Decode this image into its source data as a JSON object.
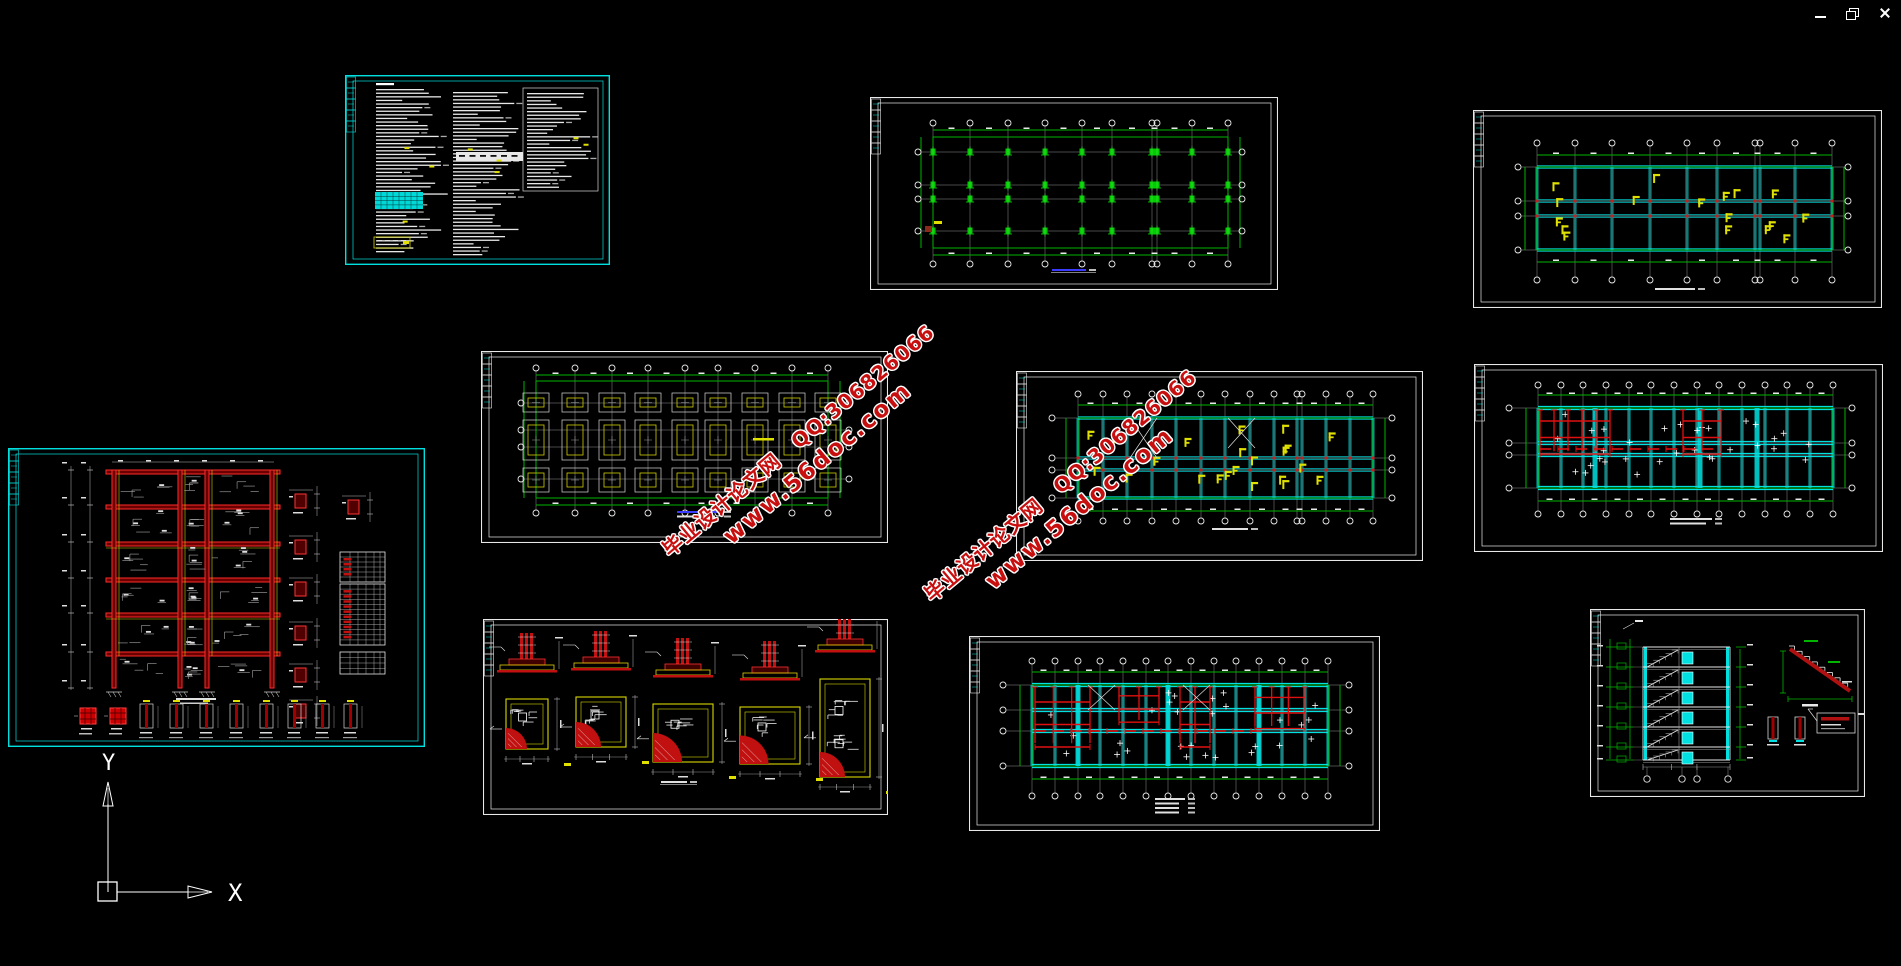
{
  "window": {
    "background": "#000000",
    "controls": [
      {
        "name": "minimize"
      },
      {
        "name": "restore"
      },
      {
        "name": "close"
      }
    ]
  },
  "ucs": {
    "x_label": "X",
    "y_label": "Y"
  },
  "watermarks": [
    {
      "x": 808,
      "y": 452,
      "rotation": -40,
      "color": "#c80f0f",
      "line1": "毕业设计论文网　QQ:306826066",
      "line2": "www.56doc.com"
    },
    {
      "x": 1070,
      "y": 497,
      "rotation": -40,
      "color": "#c80f0f",
      "line1": "毕业设计论文网　QQ:306826066",
      "line2": "www.56doc.com"
    }
  ],
  "palette": {
    "green": "#00b400",
    "bright_green": "#00d800",
    "cyan": "#00e0e0",
    "red": "#e01010",
    "dark_red": "#6a0000",
    "yellow": "#e0e000",
    "gray": "#9a9a9a",
    "white": "#e8e8e8",
    "blue_title": "#3b3bff"
  },
  "drawings": [
    {
      "id": "notes-sheet",
      "type": "notes",
      "x": 345,
      "y": 75,
      "w": 265,
      "h": 190,
      "border": "cyan",
      "seed": 11
    },
    {
      "id": "column-layout-plan",
      "type": "columns",
      "x": 870,
      "y": 97,
      "w": 408,
      "h": 193,
      "border": "white",
      "seed": 21,
      "grid": {
        "ax": [
          63,
          100,
          138,
          175,
          212,
          242,
          282,
          287,
          322,
          358
        ],
        "rows": [
          55,
          88,
          102,
          134
        ],
        "gy0": 40,
        "gy1": 151,
        "bandT": 33,
        "bandB": 158,
        "bubT": 26,
        "bubB": 167,
        "bubL": 48,
        "bubR": 372
      },
      "title": {
        "x": 182,
        "y": 172,
        "w": 34,
        "c": "#3b3bff",
        "u": 1
      }
    },
    {
      "id": "roof-beam-plan",
      "type": "beams",
      "x": 1473,
      "y": 110,
      "w": 409,
      "h": 198,
      "border": "white",
      "seed": 31,
      "grid": {
        "ax": [
          64,
          102,
          139,
          177,
          214,
          244,
          282,
          287,
          322,
          359
        ],
        "rows": [
          57,
          91,
          106,
          140
        ],
        "gy0": 57,
        "gy1": 140,
        "bandT": 45,
        "bandB": 152,
        "bubT": 33,
        "bubB": 170,
        "bubL": 45,
        "bubR": 375
      },
      "yellow": 17,
      "title": {
        "x": 182,
        "y": 178,
        "w": 40
      }
    },
    {
      "id": "frame-reinforcement-elevation",
      "type": "frame",
      "x": 8,
      "y": 448,
      "w": 417,
      "h": 299,
      "border": "cyan",
      "seed": 41,
      "cols": [
        104,
        170,
        197,
        262
      ],
      "beams": [
        22,
        57,
        94,
        130,
        165,
        204
      ],
      "rdet": [
        [
          287,
          46
        ],
        [
          287,
          92
        ],
        [
          287,
          134
        ],
        [
          287,
          178
        ],
        [
          287,
          220
        ],
        [
          287,
          256
        ],
        [
          340,
          52
        ]
      ],
      "tables": [
        [
          332,
          104,
          45,
          30,
          6
        ],
        [
          332,
          136,
          45,
          61,
          12
        ],
        [
          332,
          204,
          45,
          22,
          4
        ]
      ],
      "bxs": [
        132,
        162,
        192,
        222,
        252,
        280,
        308,
        336
      ]
    },
    {
      "id": "foundation-plan",
      "type": "foundation",
      "x": 481,
      "y": 351,
      "w": 407,
      "h": 192,
      "border": "white",
      "seed": 51,
      "grid": {
        "ax": [
          55,
          94,
          131,
          167,
          204,
          237,
          274,
          311,
          347
        ],
        "rows": [
          52,
          79,
          96,
          128
        ],
        "gy0": 30,
        "gy1": 147,
        "bandT": 24,
        "bandB": 154,
        "bubT": 17,
        "bubB": 162,
        "bubL": 40,
        "bubR": 368
      },
      "frows": [
        {
          "y": 42,
          "h": 19
        },
        {
          "y": 69,
          "h": 40
        },
        {
          "y": 117,
          "h": 24
        }
      ],
      "title": {
        "x": 196,
        "y": 160,
        "w": 44,
        "lines": 2,
        "c": "#3b3bff"
      }
    },
    {
      "id": "floor-beam-plan",
      "type": "beams",
      "x": 1016,
      "y": 371,
      "w": 407,
      "h": 190,
      "border": "white",
      "seed": 61,
      "grid": {
        "ax": [
          62,
          87,
          111,
          136,
          160,
          185,
          209,
          234,
          258,
          281,
          286,
          310,
          334,
          357
        ],
        "rows": [
          47,
          87,
          99,
          127
        ],
        "gy0": 47,
        "gy1": 127,
        "bandT": 34,
        "bandB": 140,
        "bubT": 23,
        "bubB": 150,
        "bubL": 36,
        "bubR": 376
      },
      "yellow": 22,
      "xmarks": [
        [
          114,
          47,
          27,
          40
        ],
        [
          212,
          47,
          27,
          30
        ]
      ],
      "title": {
        "x": 196,
        "y": 157,
        "w": 36
      }
    },
    {
      "id": "slab-reinforcement-plan-1",
      "type": "slab",
      "x": 1474,
      "y": 364,
      "w": 409,
      "h": 188,
      "border": "white",
      "seed": 71,
      "grid": {
        "ax": [
          64,
          87,
          109,
          132,
          155,
          177,
          200,
          223,
          245,
          268,
          291,
          313,
          336,
          359
        ],
        "rows": [
          44,
          79,
          91,
          124
        ],
        "gy0": 44,
        "gy1": 124,
        "bandT": 31,
        "bandB": 137,
        "bubT": 21,
        "bubB": 150,
        "bubL": 35,
        "bubR": 378
      },
      "thick": [
        121,
        226,
        283
      ],
      "red": [
        [
          66,
          46,
          70,
          55
        ],
        [
          209,
          46,
          38,
          55
        ]
      ],
      "redRow": [
        66,
        246,
        85
      ],
      "plus": 32,
      "title": {
        "x": 196,
        "y": 154,
        "w": 42,
        "lines": 2
      }
    },
    {
      "id": "footing-details",
      "type": "fdetails",
      "x": 483,
      "y": 619,
      "w": 405,
      "h": 196,
      "border": "white",
      "seed": 81,
      "items": [
        {
          "cx": 44,
          "pw": 42,
          "ph": 50,
          "py": 80
        },
        {
          "cx": 118,
          "pw": 50,
          "ph": 50,
          "py": 78
        },
        {
          "cx": 200,
          "pw": 60,
          "ph": 58,
          "py": 85
        },
        {
          "cx": 287,
          "pw": 60,
          "ph": 57,
          "py": 88
        },
        {
          "cx": 362,
          "pw": 50,
          "ph": 98,
          "py": 60
        }
      ],
      "title": {
        "x": 178,
        "y": 162,
        "w": 26,
        "u": 1
      }
    },
    {
      "id": "slab-reinforcement-plan-2",
      "type": "slab",
      "x": 969,
      "y": 636,
      "w": 411,
      "h": 195,
      "border": "white",
      "seed": 91,
      "grid": {
        "ax": [
          63,
          86,
          109,
          131,
          154,
          177,
          199,
          222,
          245,
          267,
          290,
          313,
          336,
          359
        ],
        "rows": [
          49,
          74,
          95,
          130
        ],
        "gy0": 49,
        "gy1": 130,
        "bandT": 36,
        "bandB": 143,
        "bubT": 25,
        "bubB": 160,
        "bubL": 34,
        "bubR": 380
      },
      "thick": [
        109,
        199,
        290
      ],
      "red": [
        [
          66,
          51,
          55,
          75
        ],
        [
          150,
          51,
          40,
          44
        ],
        [
          211,
          51,
          30,
          75
        ],
        [
          286,
          51,
          50,
          52
        ]
      ],
      "redRow": [
        66,
        300,
        95
      ],
      "plus": 28,
      "xmarks": [
        [
          119,
          49,
          27,
          25
        ],
        [
          214,
          49,
          27,
          25
        ]
      ],
      "title": {
        "x": 186,
        "y": 162,
        "w": 30,
        "lines": 4
      }
    },
    {
      "id": "stair-section",
      "type": "stair",
      "x": 1590,
      "y": 609,
      "w": 275,
      "h": 188,
      "border": "white",
      "seed": 101,
      "floors": [
        38,
        58,
        78,
        98,
        118,
        138,
        151
      ],
      "win_x": 92,
      "sec": [
        53,
        140
      ],
      "bub": [
        57,
        92,
        107,
        138
      ]
    }
  ]
}
